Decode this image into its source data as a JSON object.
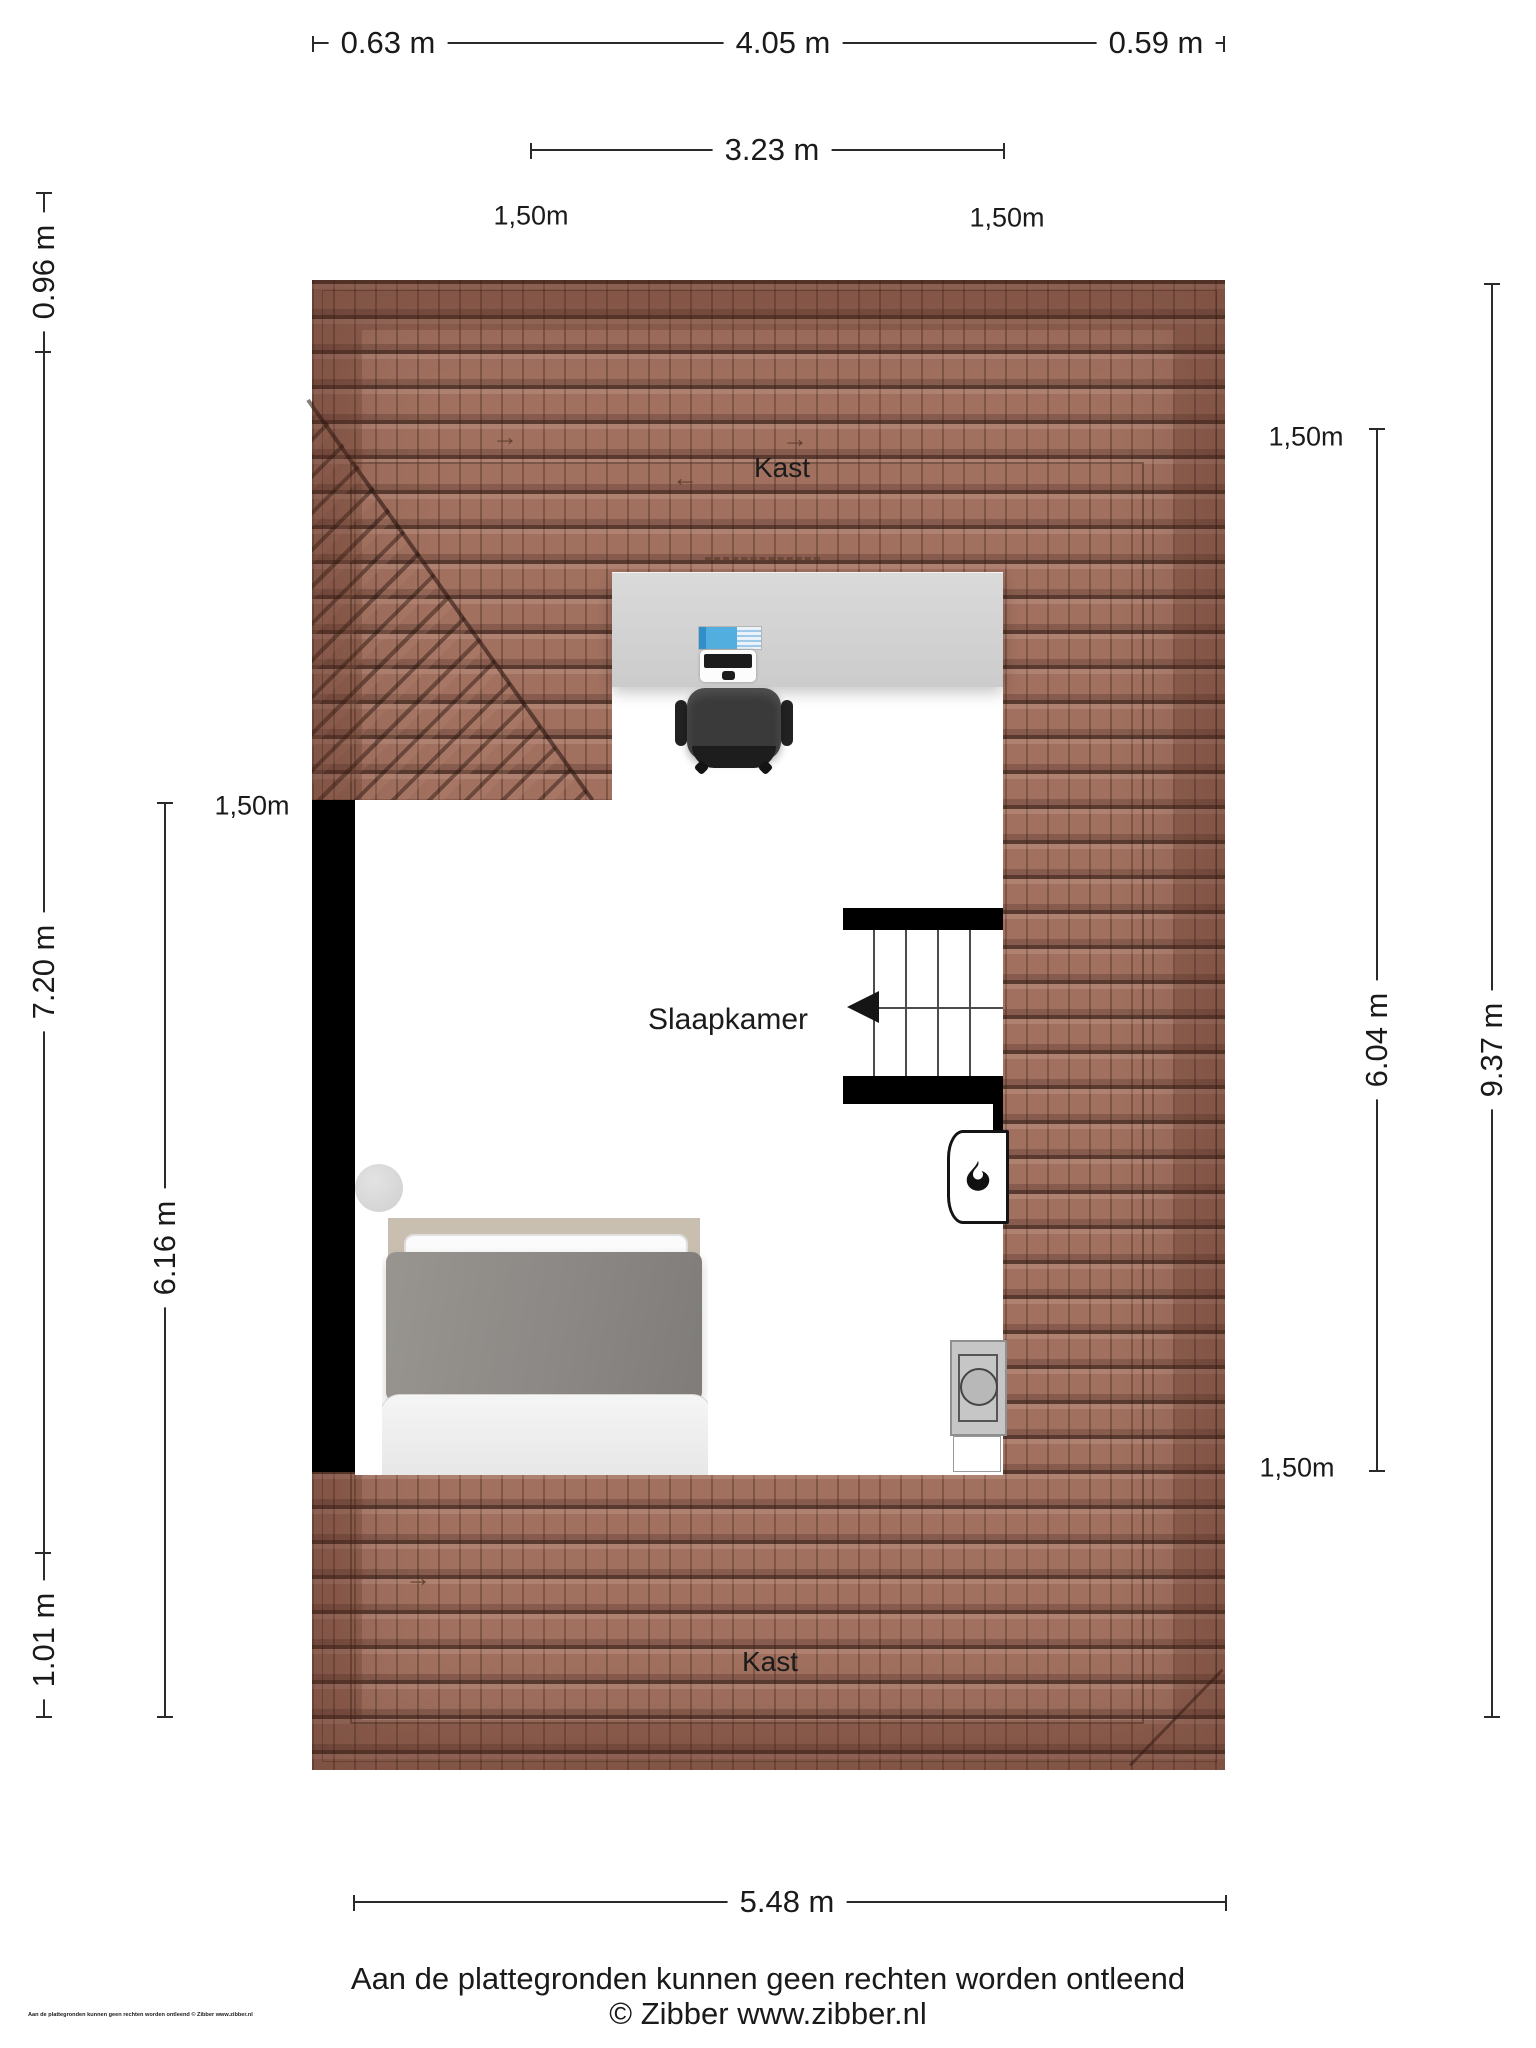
{
  "rooms": {
    "closet_top_label": "Kast",
    "bedroom_label": "Slaapkamer",
    "closet_bottom_label": "Kast"
  },
  "dimensions": {
    "top_row": [
      "0.63 m",
      "4.05 m",
      "0.59 m"
    ],
    "top_inner": "3.23 m",
    "bottom": "5.48 m",
    "left": {
      "top": "0.96 m",
      "middle": "7.20 m",
      "bottom": "1.01 m",
      "inner": "6.16 m"
    },
    "right": {
      "inner": "6.04 m",
      "outer": "9.37 m"
    }
  },
  "height_markers": {
    "top_left": "1,50m",
    "top_right": "1,50m",
    "left": "1,50m",
    "right_top": "1,50m",
    "right_bottom": "1,50m"
  },
  "icons": {
    "arrow_right": "→",
    "arrow_left": "←",
    "stair_direction": "left",
    "flame": "flame-icon",
    "washer_door": "circle"
  },
  "footer": {
    "disclaimer": "Aan de plattegronden kunnen geen rechten worden ontleend",
    "copyright": "© Zibber www.zibber.nl",
    "corner_note": "Aan de plattegronden kunnen geen rechten worden ontleend © Zibber www.zibber.nl"
  },
  "colors": {
    "roof_tile": "#a1705f",
    "roof_line": "#2b1d16",
    "wall": "#000000",
    "floor": "#ffffff",
    "monitor_blue": "#52aede",
    "monitor_blue_dark": "#2f8fc9",
    "dimension_line": "#2a2a2a"
  }
}
